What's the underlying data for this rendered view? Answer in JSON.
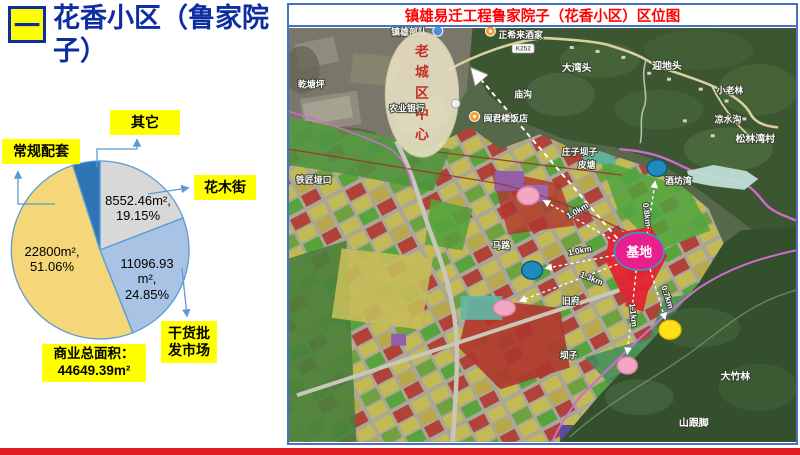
{
  "slide": {
    "section_number": "一",
    "title": "花香小区（鲁家院子）",
    "accent_yellow": "#FFFF00",
    "title_color": "#0D2DA0",
    "bottom_bar_color": "#E11B22"
  },
  "chart_data": {
    "type": "pie",
    "title": "",
    "unit": "m²",
    "start_angle_deg": 0,
    "clockwise": true,
    "outline_color": "#5B9BD5",
    "legend_position": "callouts",
    "slices": [
      {
        "name": "花木街",
        "value": 8552.46,
        "pct": 19.15,
        "color": "#D8D8D8",
        "area_label": "8552.46m²,",
        "pct_label": "19.15%"
      },
      {
        "name": "干货批发市场",
        "value": 11096.93,
        "pct": 24.85,
        "color": "#A9C3E5",
        "area_label": "11096.93 m²,",
        "pct_label": "24.85%"
      },
      {
        "name": "常规配套",
        "value": 22800,
        "pct": 51.06,
        "color": "#F5D679",
        "area_label": "22800m²,",
        "pct_label": "51.06%"
      },
      {
        "name": "其它",
        "value": null,
        "pct": 4.94,
        "color": "#2E75B6",
        "area_label": "",
        "pct_label": ""
      }
    ],
    "total": {
      "label": "商业总面积：",
      "value": "44649.39m²"
    }
  },
  "map": {
    "title": "镇雄易迁工程鲁家院子（花香小区）区位图",
    "title_color": "#FF0000",
    "border_color": "#4472C4",
    "base_label": "基地",
    "old_town_label": "老城区中心",
    "road_badge": "K252",
    "distances": [
      {
        "label": "0.8km"
      },
      {
        "label": "1.0km"
      },
      {
        "label": "1.0km"
      },
      {
        "label": "1.3km"
      },
      {
        "label": "1.1km"
      },
      {
        "label": "0.7km"
      }
    ],
    "labels": [
      {
        "text": "乾塘坪"
      },
      {
        "text": "镇雄部队"
      },
      {
        "text": "正希来酒家"
      },
      {
        "text": "农业银行"
      },
      {
        "text": "闽君楼饭店"
      },
      {
        "text": "庙沟"
      },
      {
        "text": "大湾头"
      },
      {
        "text": "迎地头"
      },
      {
        "text": "小老林"
      },
      {
        "text": "凉水沟"
      },
      {
        "text": "松林湾村"
      },
      {
        "text": "铁匠垭口"
      },
      {
        "text": "庄子坝子"
      },
      {
        "text": "皮塘"
      },
      {
        "text": "酒坊湾"
      },
      {
        "text": "马路"
      },
      {
        "text": "旧府"
      },
      {
        "text": "坝子"
      },
      {
        "text": "大竹林"
      },
      {
        "text": "山跟脚"
      }
    ]
  }
}
